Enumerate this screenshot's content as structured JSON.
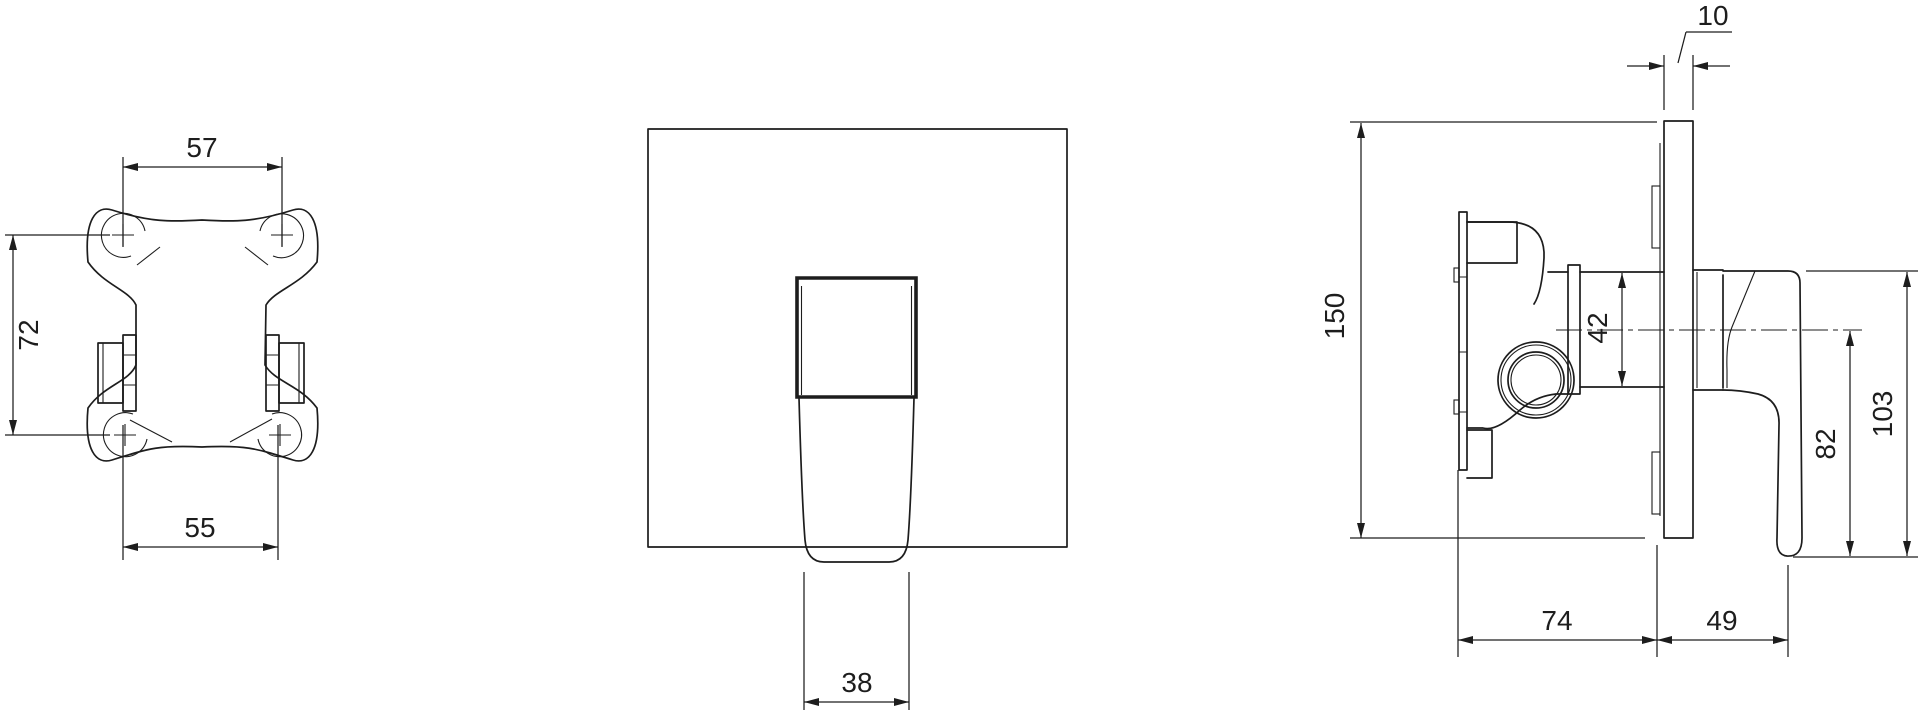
{
  "page": {
    "background": "#ffffff",
    "line_color": "#1d1d1d"
  },
  "views": {
    "back_view": {
      "dims": {
        "d57": "57",
        "d72": "72",
        "d55": "55"
      }
    },
    "front_view": {
      "dims": {
        "d38": "38"
      }
    },
    "side_view": {
      "dims": {
        "d10": "10",
        "d150": "150",
        "d42": "42",
        "d82": "82",
        "d103": "103",
        "d74": "74",
        "d49": "49"
      }
    }
  }
}
